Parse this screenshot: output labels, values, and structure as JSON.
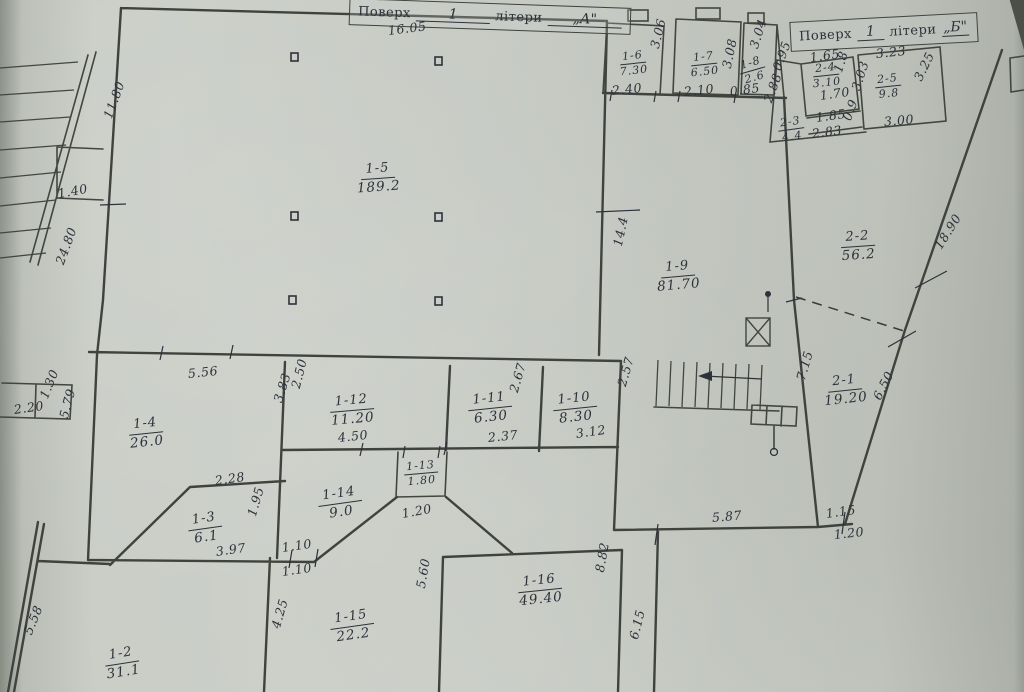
{
  "document": {
    "type": "scanned floor plan",
    "language": "uk"
  },
  "colors": {
    "paper": "#c8ccc5",
    "ink": "#2e313a",
    "wall": "#3f423d"
  },
  "title_boxes": [
    {
      "key": "a",
      "floor_label": "Поверх",
      "floor_value": "1",
      "letter_label": "літери",
      "letter_value": "„А\""
    },
    {
      "key": "b",
      "floor_label": "Поверх",
      "floor_value": "1",
      "letter_label": "літери",
      "letter_value": "„Б\""
    }
  ],
  "rooms": [
    {
      "id": "1-5",
      "area": "189.2",
      "x": 378,
      "y": 158,
      "r": -4
    },
    {
      "id": "1-6",
      "area": "7.30",
      "x": 633,
      "y": 45,
      "r": -6,
      "small": true
    },
    {
      "id": "1-7",
      "area": "6.50",
      "x": 704,
      "y": 46,
      "r": -6,
      "small": true
    },
    {
      "id": "1-8",
      "area": "2.6",
      "x": 752,
      "y": 52,
      "r": -16,
      "small": true
    },
    {
      "id": "1-9",
      "area": "81.70",
      "x": 678,
      "y": 256,
      "r": -5
    },
    {
      "id": "1-4",
      "area": "26.0",
      "x": 146,
      "y": 413,
      "r": -6
    },
    {
      "id": "1-12",
      "area": "11.20",
      "x": 352,
      "y": 390,
      "r": -5
    },
    {
      "id": "1-11",
      "area": "6.30",
      "x": 490,
      "y": 388,
      "r": -6
    },
    {
      "id": "1-10",
      "area": "8.30",
      "x": 575,
      "y": 388,
      "r": -6
    },
    {
      "id": "1-13",
      "area": "1.80",
      "x": 421,
      "y": 455,
      "r": -5,
      "small": true
    },
    {
      "id": "1-14",
      "area": "9.0",
      "x": 340,
      "y": 483,
      "r": -8
    },
    {
      "id": "1-3",
      "area": "6.1",
      "x": 205,
      "y": 508,
      "r": -8
    },
    {
      "id": "1-2",
      "area": "31.1",
      "x": 122,
      "y": 643,
      "r": -9
    },
    {
      "id": "1-15",
      "area": "22.2",
      "x": 352,
      "y": 606,
      "r": -8
    },
    {
      "id": "1-16",
      "area": "49.40",
      "x": 540,
      "y": 570,
      "r": -6
    },
    {
      "id": "2-2",
      "area": "56.2",
      "x": 858,
      "y": 226,
      "r": -4
    },
    {
      "id": "2-1",
      "area": "19.20",
      "x": 845,
      "y": 370,
      "r": -6
    },
    {
      "id": "2-3",
      "area": "4.4",
      "x": 791,
      "y": 111,
      "r": -8,
      "small": true
    },
    {
      "id": "2-4",
      "area": "3.10",
      "x": 826,
      "y": 57,
      "r": -6,
      "small": true
    },
    {
      "id": "2-5",
      "area": "9.8",
      "x": 888,
      "y": 68,
      "r": -6,
      "small": true
    }
  ],
  "dimensions": [
    {
      "t": "16.05",
      "x": 388,
      "y": 25,
      "r": -7
    },
    {
      "t": "11.80",
      "x": 108,
      "y": 112,
      "r": -70
    },
    {
      "t": "1.40",
      "x": 58,
      "y": 188,
      "r": -10
    },
    {
      "t": "24.80",
      "x": 60,
      "y": 258,
      "r": -70
    },
    {
      "t": "2.20",
      "x": 14,
      "y": 404,
      "r": -8
    },
    {
      "t": "1.30",
      "x": 44,
      "y": 392,
      "r": -68
    },
    {
      "t": "5.79",
      "x": 64,
      "y": 412,
      "r": -75
    },
    {
      "t": "5.56",
      "x": 188,
      "y": 368,
      "r": -6
    },
    {
      "t": "2.50",
      "x": 296,
      "y": 382,
      "r": -76
    },
    {
      "t": "3.83",
      "x": 278,
      "y": 396,
      "r": -72
    },
    {
      "t": "4.50",
      "x": 338,
      "y": 432,
      "r": -6
    },
    {
      "t": "2.67",
      "x": 514,
      "y": 386,
      "r": -74
    },
    {
      "t": "2.37",
      "x": 488,
      "y": 432,
      "r": -6
    },
    {
      "t": "3.12",
      "x": 576,
      "y": 428,
      "r": -8
    },
    {
      "t": "2.57",
      "x": 622,
      "y": 380,
      "r": -74
    },
    {
      "t": "14.4",
      "x": 618,
      "y": 240,
      "r": -78
    },
    {
      "t": "2.28",
      "x": 215,
      "y": 475,
      "r": -8
    },
    {
      "t": "1.95",
      "x": 252,
      "y": 510,
      "r": -74
    },
    {
      "t": "3.97",
      "x": 216,
      "y": 546,
      "r": -8
    },
    {
      "t": "1.10",
      "x": 282,
      "y": 542,
      "r": -8
    },
    {
      "t": "1.10",
      "x": 282,
      "y": 566,
      "r": -8
    },
    {
      "t": "1.20",
      "x": 402,
      "y": 508,
      "r": -10
    },
    {
      "t": "2.40",
      "x": 612,
      "y": 85,
      "r": -6
    },
    {
      "t": "3.06",
      "x": 655,
      "y": 42,
      "r": -76
    },
    {
      "t": "2.10",
      "x": 684,
      "y": 86,
      "r": -6
    },
    {
      "t": "3.08",
      "x": 727,
      "y": 62,
      "r": -78
    },
    {
      "t": "3.04",
      "x": 754,
      "y": 42,
      "r": -72
    },
    {
      "t": "0.85",
      "x": 730,
      "y": 86,
      "r": -8
    },
    {
      "t": "0.95",
      "x": 777,
      "y": 64,
      "r": -70
    },
    {
      "t": "2.88",
      "x": 768,
      "y": 96,
      "r": -70
    },
    {
      "t": "1.65",
      "x": 810,
      "y": 52,
      "r": -8
    },
    {
      "t": "1.8",
      "x": 838,
      "y": 66,
      "r": -72
    },
    {
      "t": "1.70",
      "x": 820,
      "y": 90,
      "r": -8
    },
    {
      "t": "1.85",
      "x": 816,
      "y": 112,
      "r": -8
    },
    {
      "t": "0.9",
      "x": 847,
      "y": 114,
      "r": -70
    },
    {
      "t": "2.83",
      "x": 812,
      "y": 128,
      "r": -7
    },
    {
      "t": "3.23",
      "x": 876,
      "y": 48,
      "r": -6
    },
    {
      "t": "3.03",
      "x": 856,
      "y": 84,
      "r": -72
    },
    {
      "t": "3.25",
      "x": 918,
      "y": 74,
      "r": -64
    },
    {
      "t": "3.00",
      "x": 884,
      "y": 116,
      "r": -5
    },
    {
      "t": "18.90",
      "x": 938,
      "y": 242,
      "r": -58
    },
    {
      "t": "7.15",
      "x": 801,
      "y": 374,
      "r": -74
    },
    {
      "t": "6.50",
      "x": 877,
      "y": 393,
      "r": -63
    },
    {
      "t": "5.87",
      "x": 712,
      "y": 512,
      "r": -5
    },
    {
      "t": "1.15",
      "x": 826,
      "y": 508,
      "r": -8
    },
    {
      "t": "1.20",
      "x": 834,
      "y": 529,
      "r": -6
    },
    {
      "t": "8.82",
      "x": 600,
      "y": 566,
      "r": -80
    },
    {
      "t": "5.60",
      "x": 421,
      "y": 582,
      "r": -80
    },
    {
      "t": "6.15",
      "x": 634,
      "y": 633,
      "r": -76
    },
    {
      "t": "4.25",
      "x": 276,
      "y": 622,
      "r": -74
    },
    {
      "t": "5.58",
      "x": 28,
      "y": 628,
      "r": -68
    }
  ]
}
